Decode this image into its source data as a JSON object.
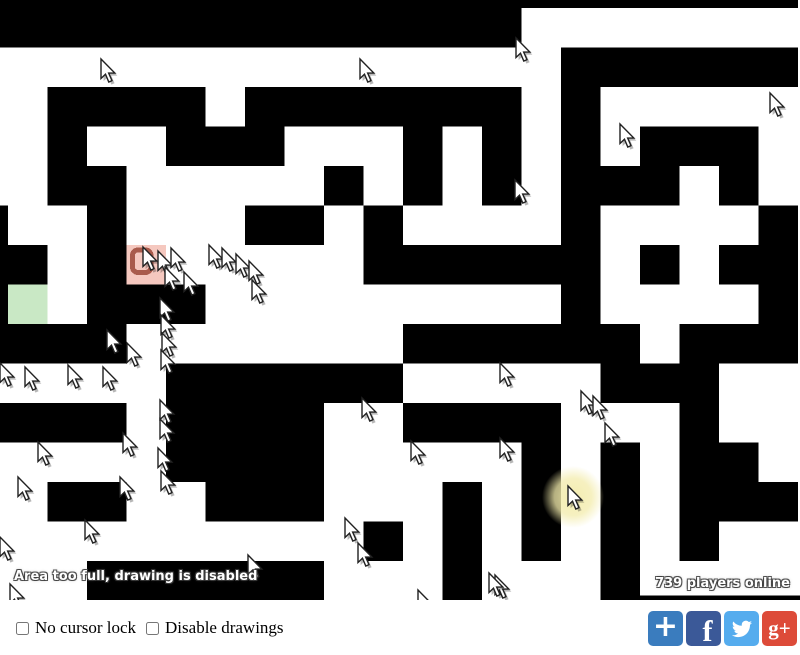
{
  "window": {
    "width": 800,
    "height": 655
  },
  "game": {
    "status_text": "Area too full, drawing is disabled",
    "players_text": "739 players online",
    "colors": {
      "wall": "#000000",
      "floor": "#ffffff",
      "start_fill": "#c9e8c5",
      "goal_fill": "#f5c8bf",
      "goal_icon_stroke": "#96402f",
      "glow_fill": "#f3ecac",
      "cursor_fill": "#ffffff",
      "cursor_stroke": "#222222"
    },
    "maze": {
      "cols": 21,
      "rows": 16,
      "cell_size": 40,
      "model_width": 810,
      "model_height": 607.5,
      "rows_data": [
        "#####################",
        "##############.......",
        "...............######",
        "..####.#######.#.....",
        "..#..###...#.#.#.###.",
        "..##.....#.#.#.###.#.",
        "#..#...##.#....#....#",
        "##.#R.....######.#.##",
        "#G.###.........#....#",
        "####.......######.###",
        ".....######.....###..",
        "####.####..####...#..",
        ".....####.....#.#.##.",
        "..##..###...#.#.#.###",
        "..........#.#.#.#.#..",
        "...######...#...#...."
      ],
      "extra_wall_rects": [
        {
          "x": 617,
          "y": 603,
          "w": 193,
          "h": 5
        }
      ]
    },
    "goal_icon": {
      "x": 134,
      "y": 253,
      "w": 19,
      "h": 23,
      "rx": 6
    },
    "click_glow": {
      "x": 573,
      "y": 497,
      "r": 31
    },
    "cursors": [
      [
        101,
        59
      ],
      [
        360,
        59
      ],
      [
        516,
        38
      ],
      [
        770,
        93
      ],
      [
        620,
        124
      ],
      [
        515,
        180
      ],
      [
        143,
        247
      ],
      [
        158,
        251
      ],
      [
        171,
        248
      ],
      [
        209,
        245
      ],
      [
        222,
        248
      ],
      [
        236,
        254
      ],
      [
        249,
        261
      ],
      [
        165,
        267
      ],
      [
        184,
        272
      ],
      [
        252,
        280
      ],
      [
        160,
        298
      ],
      [
        161,
        315
      ],
      [
        162,
        333
      ],
      [
        161,
        350
      ],
      [
        107,
        330
      ],
      [
        127,
        343
      ],
      [
        0,
        363
      ],
      [
        25,
        367
      ],
      [
        68,
        365
      ],
      [
        103,
        367
      ],
      [
        160,
        400
      ],
      [
        160,
        419
      ],
      [
        158,
        448
      ],
      [
        161,
        471
      ],
      [
        123,
        433
      ],
      [
        38,
        442
      ],
      [
        18,
        477
      ],
      [
        120,
        477
      ],
      [
        85,
        520
      ],
      [
        0,
        537
      ],
      [
        248,
        555
      ],
      [
        345,
        518
      ],
      [
        358,
        543
      ],
      [
        10,
        584
      ],
      [
        495,
        575
      ],
      [
        362,
        398
      ],
      [
        500,
        363
      ],
      [
        581,
        391
      ],
      [
        593,
        396
      ],
      [
        605,
        423
      ],
      [
        411,
        441
      ],
      [
        500,
        438
      ],
      [
        568,
        486
      ],
      [
        489,
        573
      ],
      [
        418,
        590
      ]
    ]
  },
  "controls": {
    "no_cursor_lock_label": "No cursor lock",
    "no_cursor_lock_checked": false,
    "disable_drawings_label": "Disable drawings",
    "disable_drawings_checked": false
  },
  "share_buttons": [
    {
      "name": "addthis-share-button",
      "bg": "#3a7cbe",
      "glyph": "plus",
      "text": "+"
    },
    {
      "name": "facebook-button",
      "bg": "#3b5998",
      "glyph": "f",
      "text": "f"
    },
    {
      "name": "twitter-button",
      "bg": "#55acee",
      "glyph": "bird",
      "text": ""
    },
    {
      "name": "googleplus-button",
      "bg": "#dd4b39",
      "glyph": "gplus",
      "text": "g+"
    }
  ]
}
